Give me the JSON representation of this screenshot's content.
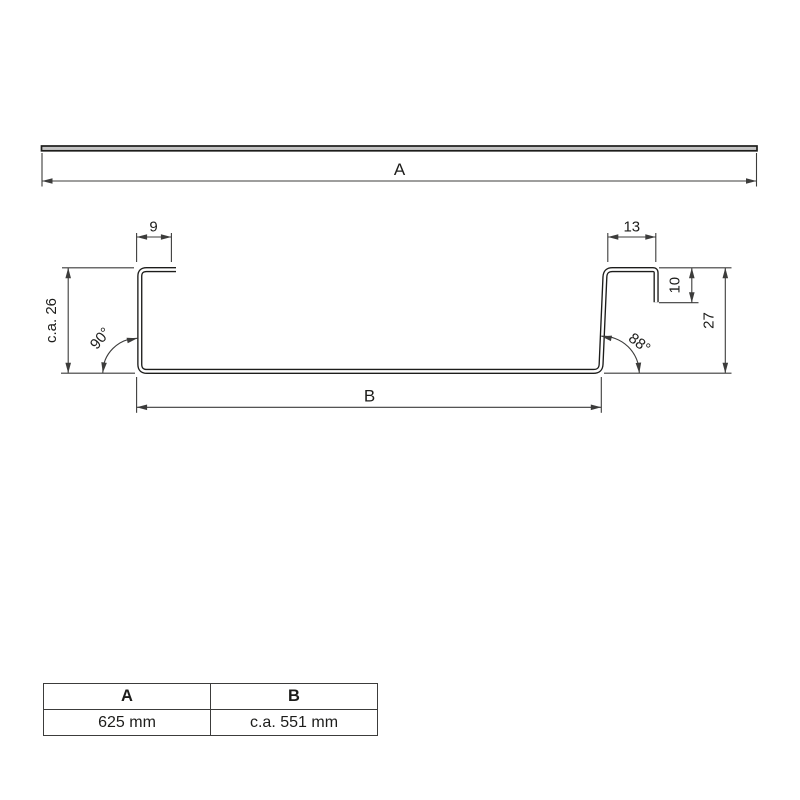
{
  "colors": {
    "line": "#1d1d1b",
    "dim": "#3c3c3b",
    "strip_fill": "#c4c4c4",
    "background": "#ffffff"
  },
  "flat_view": {
    "width_label": "A"
  },
  "profile_view": {
    "left_flange_width": "9",
    "right_flange_width": "13",
    "right_lip_length": "10",
    "right_height": "27",
    "left_height": "c.a. 26",
    "left_angle": "90°",
    "right_angle": "88°",
    "base_width": "B"
  },
  "dimension_table": {
    "headers": [
      "A",
      "B"
    ],
    "rows": [
      [
        "625 mm",
        "c.a. 551 mm"
      ]
    ]
  }
}
